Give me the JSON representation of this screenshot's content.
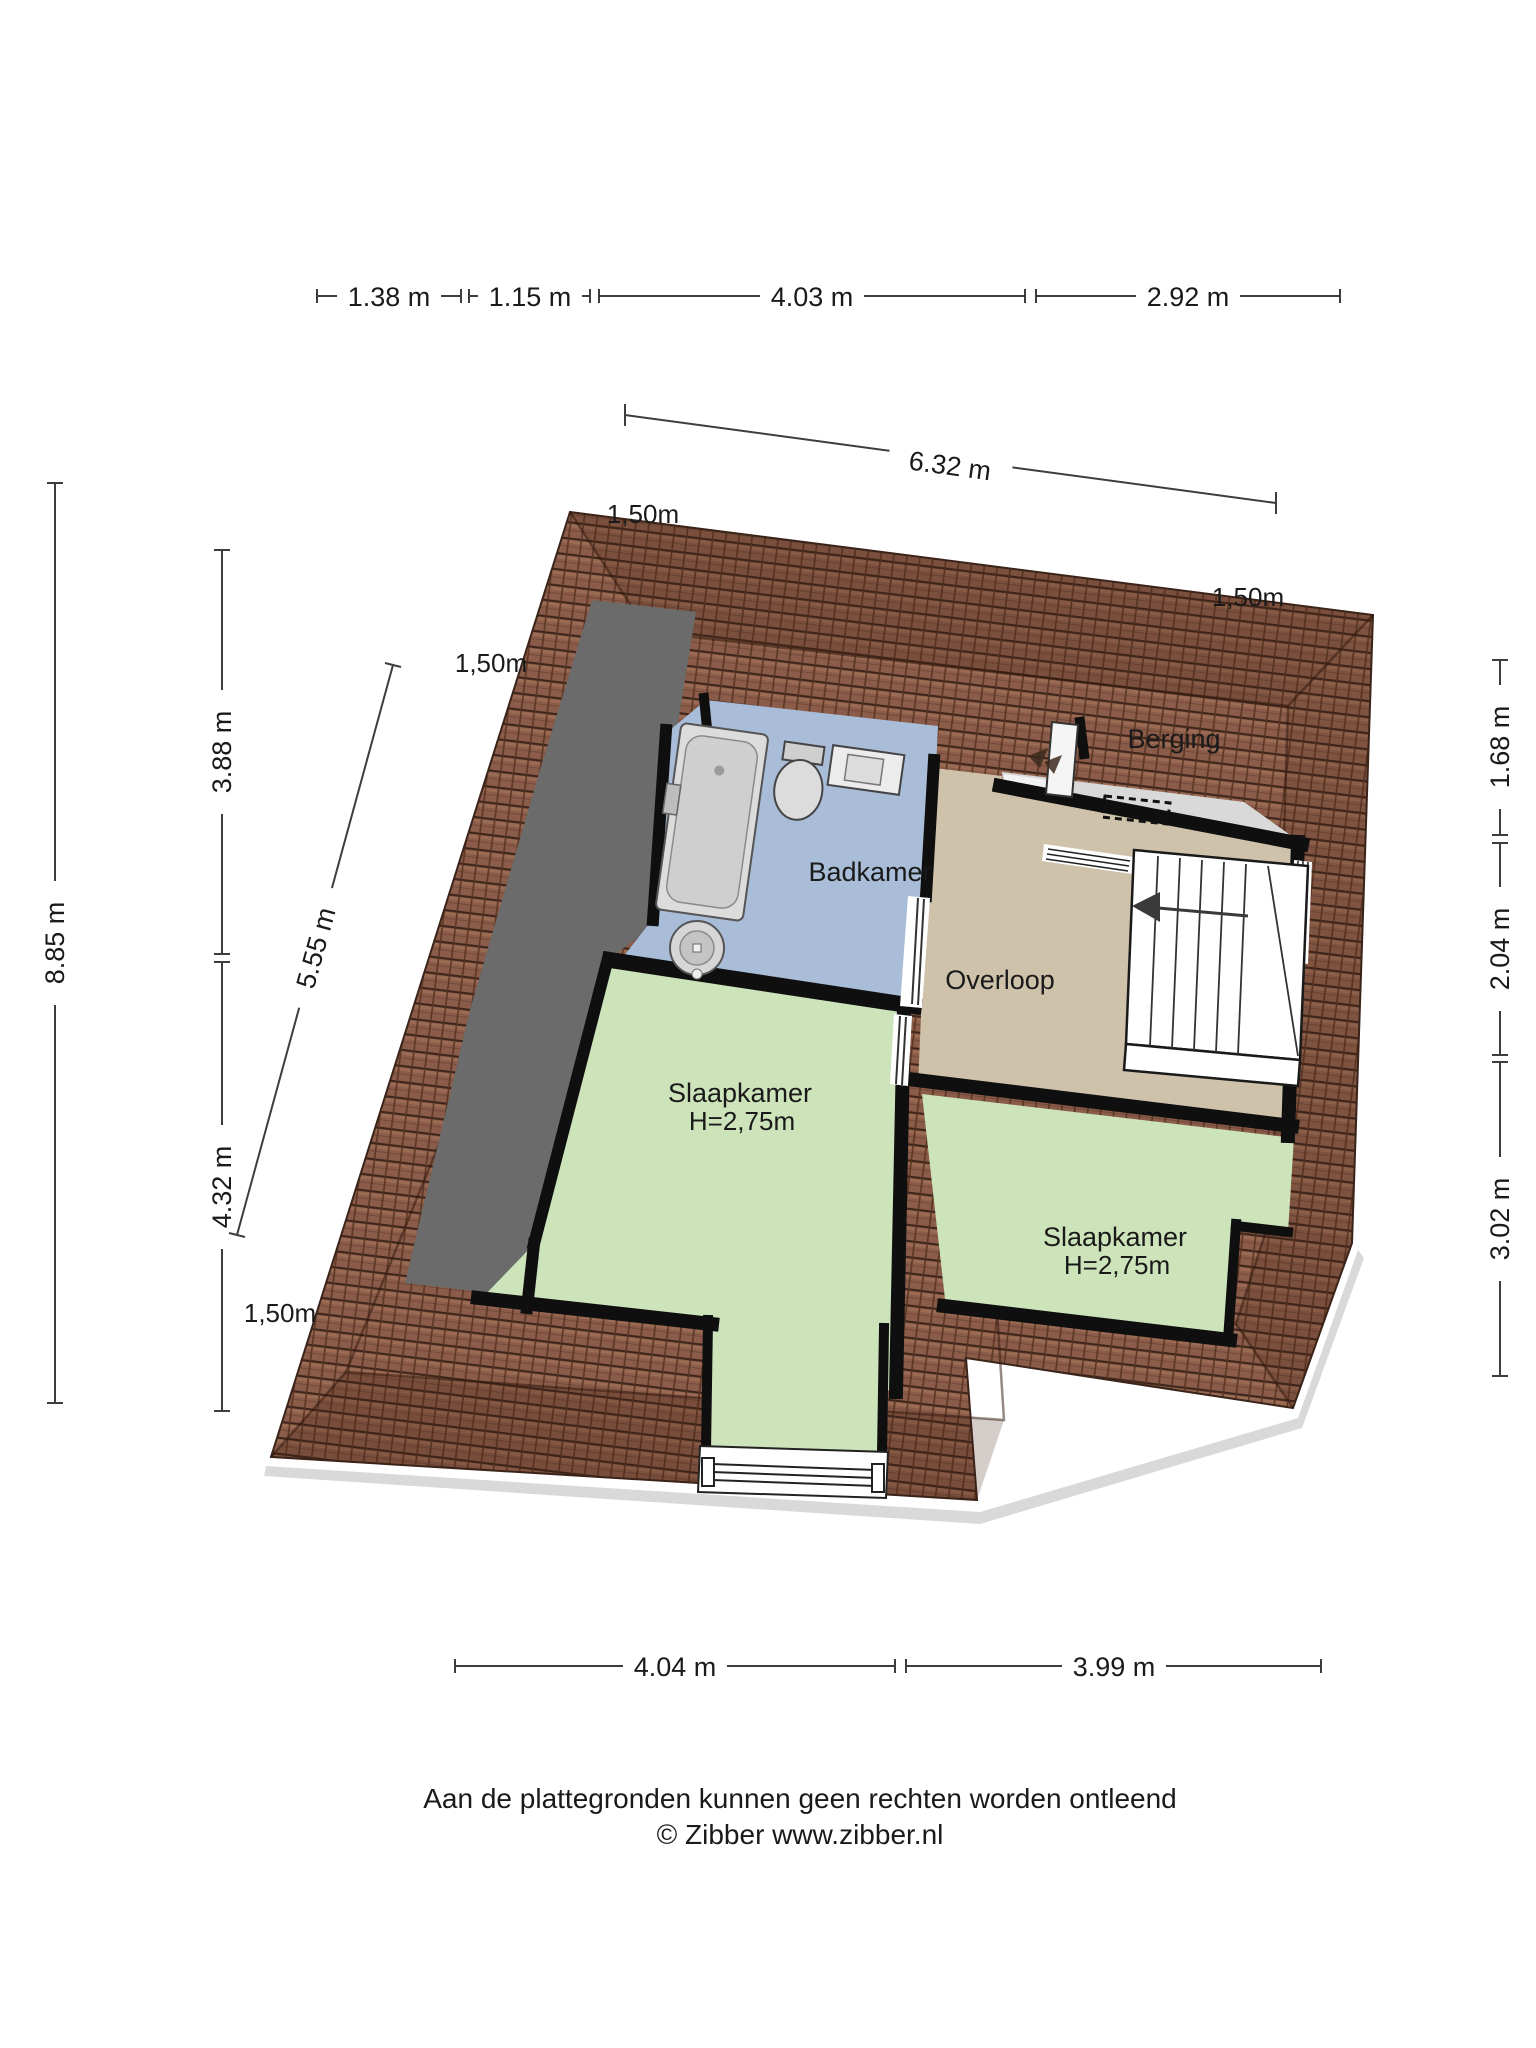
{
  "document": {
    "type": "floorplan",
    "floor": "verdieping"
  },
  "rooms": {
    "badkamer": {
      "label": "Badkamer"
    },
    "berging": {
      "label": "Berging"
    },
    "overloop": {
      "label": "Overloop"
    },
    "slaapkamer_links": {
      "label": "Slaapkamer",
      "ceiling": "H=2,75m"
    },
    "slaapkamer_rechts": {
      "label": "Slaapkamer",
      "ceiling": "H=2,75m"
    }
  },
  "dimensions": {
    "top": [
      "1.38 m",
      "1.15 m",
      "4.03 m",
      "2.92 m"
    ],
    "width_total": "6.32 m",
    "left_total": "8.85 m",
    "left_segments": [
      "3.88 m",
      "4.32 m"
    ],
    "diagonal": "5.55 m",
    "right_segments": [
      "1.68 m",
      "2.04 m",
      "3.02 m"
    ],
    "bottom": [
      "4.04 m",
      "3.99 m"
    ],
    "roof_overhang": "1,50m"
  },
  "footer": {
    "disclaimer": "Aan de plattegronden kunnen geen rechten worden ontleend",
    "copyright": "© Zibber www.zibber.nl"
  },
  "colors": {
    "roof_tile": "#8a5c49",
    "roof_line": "#3f261c",
    "bathroom_floor": "#a9bdd8",
    "bedroom_floor": "#cde3ba",
    "landing_floor": "#cfc2ab",
    "storage_floor": "#d9d9d9",
    "sloped_ceiling": "#6b6b6b",
    "wall": "#0f0f0f"
  }
}
